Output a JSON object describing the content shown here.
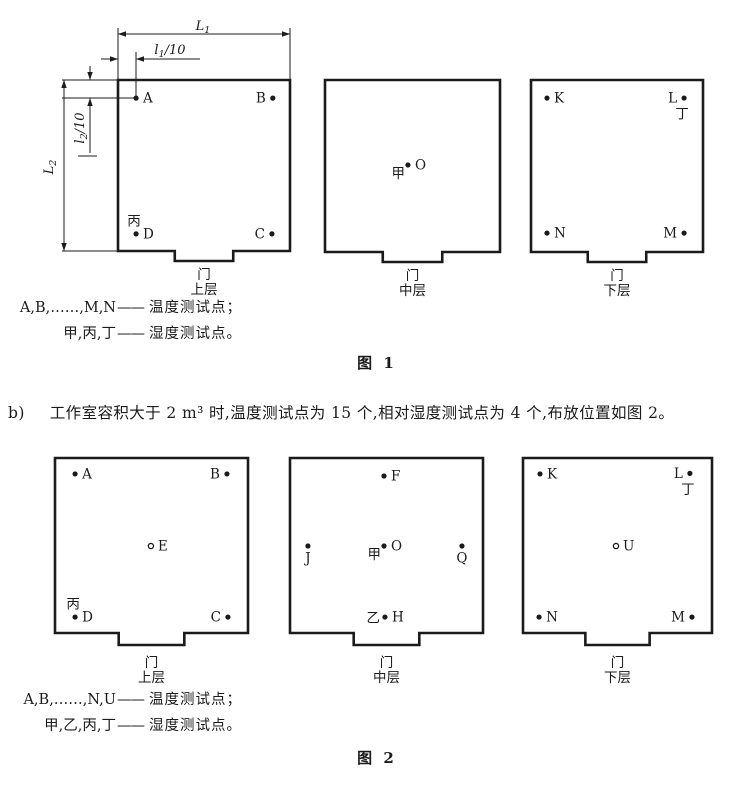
{
  "figure1": {
    "caption": "图 1",
    "dimension_labels": {
      "width": "L₁",
      "width_tenth": "l₁/10",
      "height_tenth": "l₂/10",
      "height": "L₂"
    },
    "rooms": [
      {
        "door_label": "门",
        "layer_label": "上层",
        "points": [
          {
            "label": "A",
            "marker": "dot",
            "x": 0.105,
            "y": 0.106,
            "label_side": "right"
          },
          {
            "label": "B",
            "marker": "dot",
            "x": 0.9,
            "y": 0.106,
            "label_side": "left"
          },
          {
            "label": "C",
            "marker": "dot",
            "x": 0.895,
            "y": 0.9,
            "label_side": "left"
          },
          {
            "label": "D",
            "marker": "dot",
            "x": 0.105,
            "y": 0.9,
            "label_side": "right",
            "humidity_label": {
              "text": "丙",
              "side": "above"
            }
          }
        ]
      },
      {
        "door_label": "门",
        "layer_label": "中层",
        "points": [
          {
            "label": "O",
            "marker": "dot",
            "x": 0.474,
            "y": 0.494,
            "label_side": "right",
            "humidity_label": {
              "text": "甲",
              "side": "belowleft"
            }
          }
        ]
      },
      {
        "door_label": "门",
        "layer_label": "下层",
        "points": [
          {
            "label": "K",
            "marker": "dot",
            "x": 0.093,
            "y": 0.105,
            "label_side": "right"
          },
          {
            "label": "L",
            "marker": "dot",
            "x": 0.89,
            "y": 0.105,
            "label_side": "left",
            "humidity_label": {
              "text": "丁",
              "side": "below"
            }
          },
          {
            "label": "N",
            "marker": "dot",
            "x": 0.093,
            "y": 0.89,
            "label_side": "right"
          },
          {
            "label": "M",
            "marker": "dot",
            "x": 0.89,
            "y": 0.89,
            "label_side": "left"
          }
        ]
      }
    ],
    "legend": [
      {
        "term": "A,B,……,M,N",
        "dash": "——",
        "desc": "温度测试点；"
      },
      {
        "term": "甲,丙,丁",
        "dash": "——",
        "desc": "湿度测试点。"
      }
    ]
  },
  "paragraph_b": {
    "marker": "b)",
    "text": "工作室容积大于 2 m³ 时,温度测试点为 15 个,相对湿度测试点为 4 个,布放位置如图 2。"
  },
  "figure2": {
    "caption": "图 2",
    "rooms": [
      {
        "door_label": "门",
        "layer_label": "上层",
        "points": [
          {
            "label": "A",
            "marker": "dot",
            "x": 0.104,
            "y": 0.091,
            "label_side": "right"
          },
          {
            "label": "B",
            "marker": "dot",
            "x": 0.891,
            "y": 0.091,
            "label_side": "left"
          },
          {
            "label": "E",
            "marker": "open",
            "x": 0.497,
            "y": 0.503,
            "label_side": "right"
          },
          {
            "label": "D",
            "marker": "dot",
            "x": 0.104,
            "y": 0.909,
            "label_side": "right",
            "humidity_label": {
              "text": "丙",
              "side": "above"
            }
          },
          {
            "label": "C",
            "marker": "dot",
            "x": 0.896,
            "y": 0.909,
            "label_side": "left"
          }
        ]
      },
      {
        "door_label": "门",
        "layer_label": "中层",
        "points": [
          {
            "label": "F",
            "marker": "dot",
            "x": 0.487,
            "y": 0.103,
            "label_side": "right"
          },
          {
            "label": "J",
            "marker": "dot",
            "x": 0.093,
            "y": 0.503,
            "label_side": "below"
          },
          {
            "label": "O",
            "marker": "dot",
            "x": 0.487,
            "y": 0.503,
            "label_side": "right",
            "humidity_label": {
              "text": "甲",
              "side": "belowleft"
            }
          },
          {
            "label": "Q",
            "marker": "dot",
            "x": 0.891,
            "y": 0.503,
            "label_side": "below"
          },
          {
            "label": "H",
            "marker": "dot",
            "x": 0.492,
            "y": 0.909,
            "label_side": "right",
            "humidity_label": {
              "text": "乙",
              "side": "left"
            }
          }
        ]
      },
      {
        "door_label": "门",
        "layer_label": "下层",
        "points": [
          {
            "label": "K",
            "marker": "dot",
            "x": 0.09,
            "y": 0.091,
            "label_side": "right"
          },
          {
            "label": "L",
            "marker": "dot",
            "x": 0.883,
            "y": 0.088,
            "label_side": "left",
            "humidity_label": {
              "text": "丁",
              "side": "below"
            }
          },
          {
            "label": "U",
            "marker": "open",
            "x": 0.492,
            "y": 0.503,
            "label_side": "right"
          },
          {
            "label": "N",
            "marker": "dot",
            "x": 0.085,
            "y": 0.909,
            "label_side": "right"
          },
          {
            "label": "M",
            "marker": "dot",
            "x": 0.894,
            "y": 0.909,
            "label_side": "left"
          }
        ]
      }
    ],
    "legend": [
      {
        "term": "A,B,……,N,U",
        "dash": "——",
        "desc": "温度测试点；"
      },
      {
        "term": "甲,乙,丙,丁",
        "dash": "——",
        "desc": "湿度测试点。"
      }
    ]
  }
}
